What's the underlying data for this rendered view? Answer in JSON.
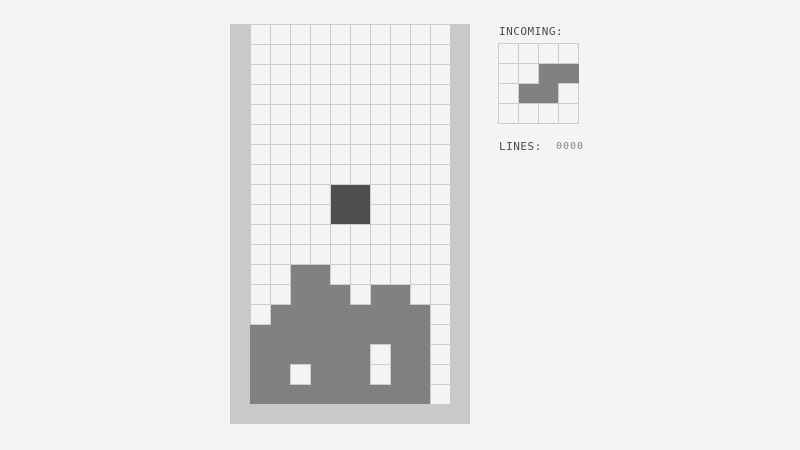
{
  "colors": {
    "background": "#f4f4f4",
    "wall": "#c9c9c9",
    "grid_line": "#cccccc",
    "cell_empty": "#f4f4f4",
    "stack_block": "#818181",
    "active_block": "#4e4e4e",
    "preview_block": "#818181",
    "label_text": "#4a4a4a",
    "counter_text": "#858585"
  },
  "playfield": {
    "rows": 19,
    "cols": 10,
    "active_piece": {
      "type": "O",
      "cells": [
        [
          8,
          4
        ],
        [
          8,
          5
        ],
        [
          9,
          4
        ],
        [
          9,
          5
        ]
      ]
    },
    "stack_cells": [
      [
        12,
        2
      ],
      [
        12,
        3
      ],
      [
        13,
        2
      ],
      [
        13,
        3
      ],
      [
        13,
        4
      ],
      [
        13,
        6
      ],
      [
        13,
        7
      ],
      [
        14,
        1
      ],
      [
        14,
        2
      ],
      [
        14,
        3
      ],
      [
        14,
        4
      ],
      [
        14,
        5
      ],
      [
        14,
        6
      ],
      [
        14,
        7
      ],
      [
        14,
        8
      ],
      [
        15,
        0
      ],
      [
        15,
        1
      ],
      [
        15,
        2
      ],
      [
        15,
        3
      ],
      [
        15,
        4
      ],
      [
        15,
        5
      ],
      [
        15,
        6
      ],
      [
        15,
        7
      ],
      [
        15,
        8
      ],
      [
        16,
        0
      ],
      [
        16,
        1
      ],
      [
        16,
        2
      ],
      [
        16,
        3
      ],
      [
        16,
        4
      ],
      [
        16,
        5
      ],
      [
        16,
        7
      ],
      [
        16,
        8
      ],
      [
        17,
        0
      ],
      [
        17,
        1
      ],
      [
        17,
        3
      ],
      [
        17,
        4
      ],
      [
        17,
        5
      ],
      [
        17,
        7
      ],
      [
        17,
        8
      ],
      [
        18,
        0
      ],
      [
        18,
        1
      ],
      [
        18,
        2
      ],
      [
        18,
        3
      ],
      [
        18,
        4
      ],
      [
        18,
        5
      ],
      [
        18,
        6
      ],
      [
        18,
        7
      ],
      [
        18,
        8
      ]
    ]
  },
  "sidebar": {
    "incoming_label": "INCOMING:",
    "preview": {
      "type": "S",
      "rows": 4,
      "cols": 4,
      "cells": [
        [
          1,
          2
        ],
        [
          1,
          3
        ],
        [
          2,
          1
        ],
        [
          2,
          2
        ]
      ]
    },
    "lines_label": "LINES:",
    "lines_value": "0000"
  }
}
